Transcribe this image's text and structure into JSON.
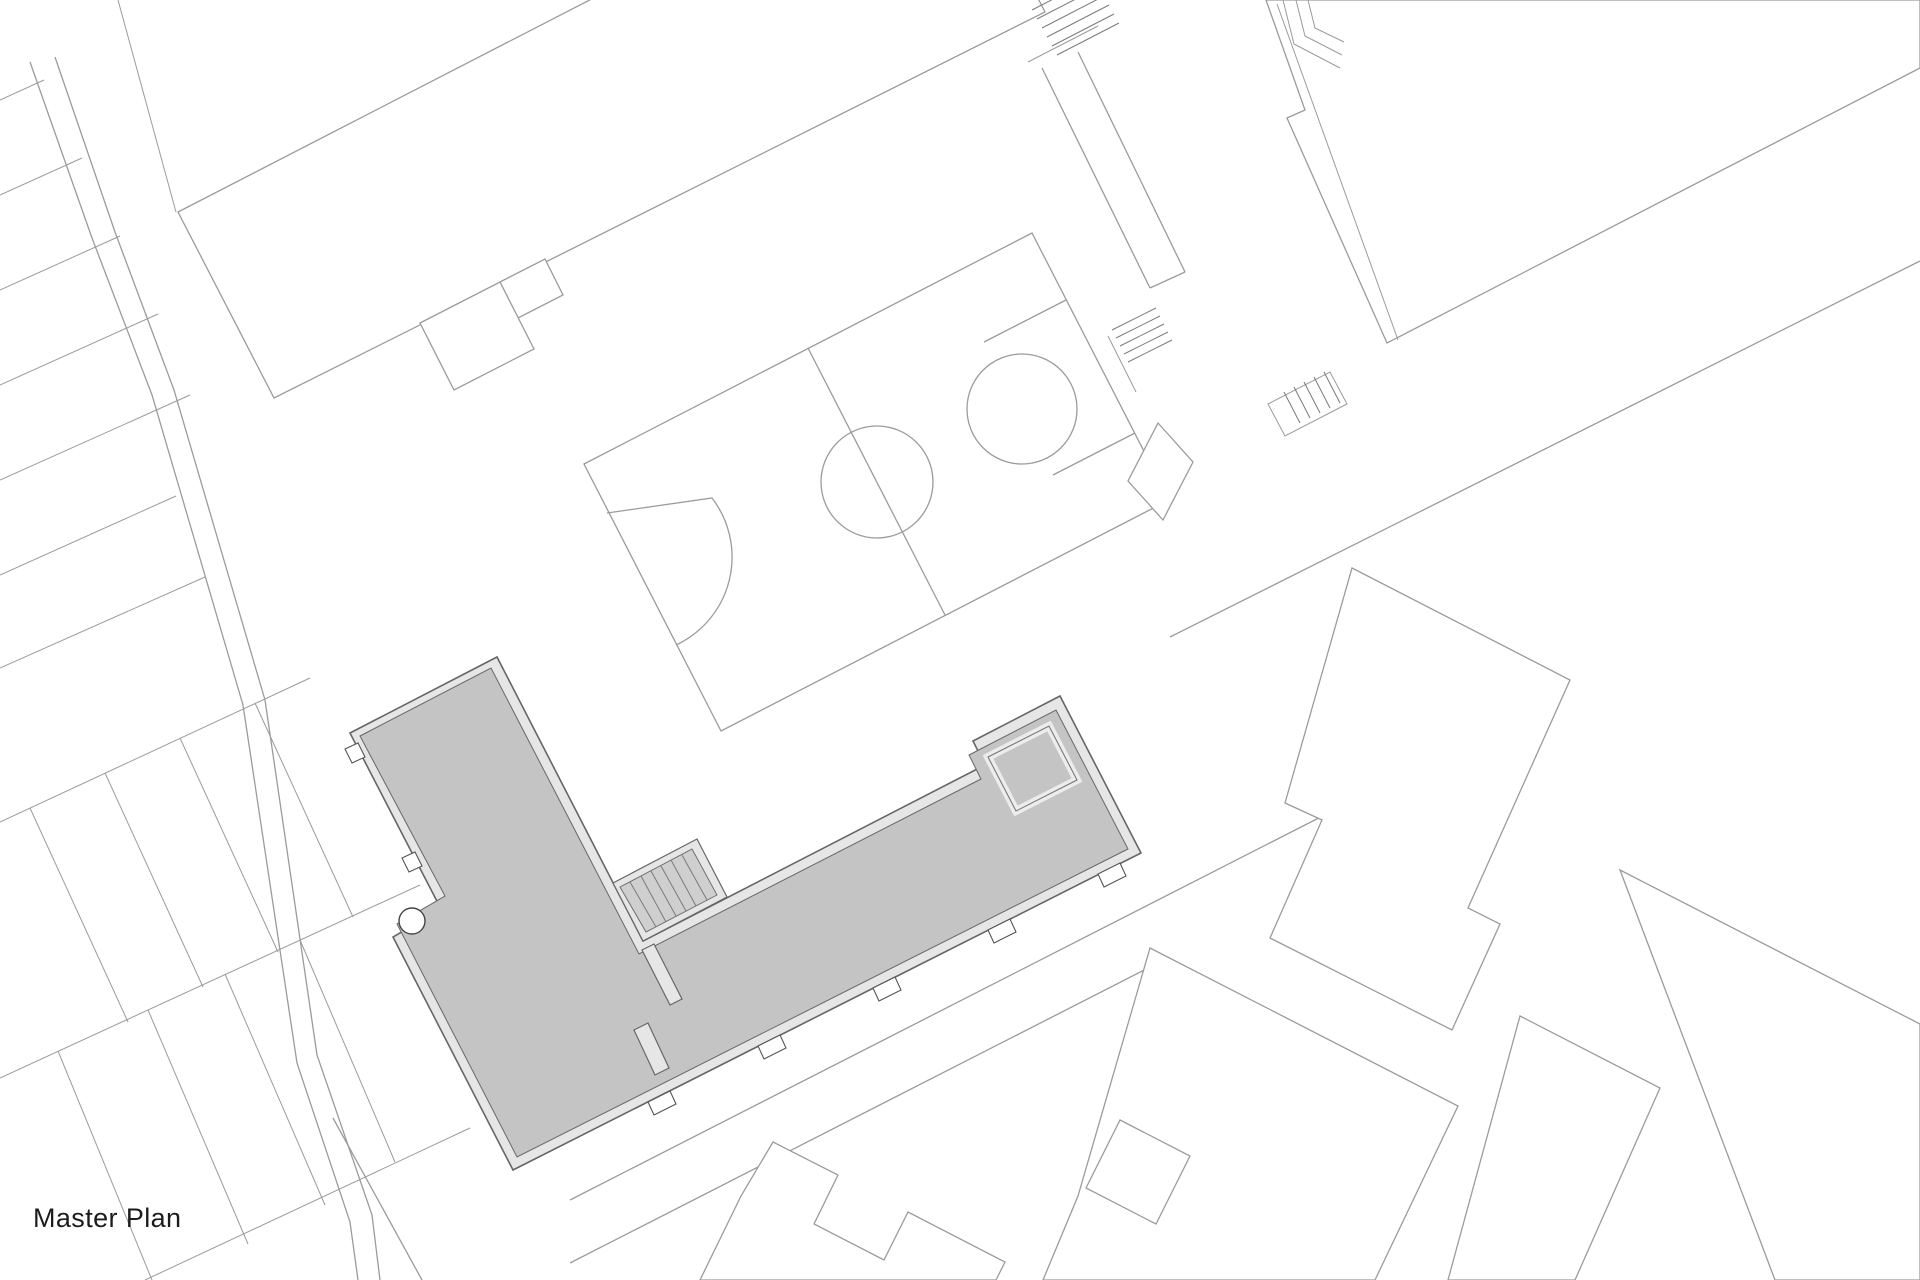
{
  "title": {
    "label": "Master Plan"
  },
  "colors": {
    "bg": "#ffffff",
    "line": "#9b9b9b",
    "text": "#1c1c1c",
    "hl": "#c4c4c4",
    "wall": "#e6e6e6",
    "hl-line": "#666666"
  },
  "site": {
    "type": "architectural site plan",
    "highlighted_building": "L-shaped building with thick walls, interior stair, wall stubs and facade entry ticks",
    "features": [
      "basketball-court with center circle, center line, three-point arc and free-throw circle",
      "large white building top-left with stepped lower notch",
      "narrow walkway strip with two exterior stairs top-right",
      "large white building top-right with nested corner ramp lines and exterior stair",
      "square pad east of court",
      "two parallel street lines south of highlighted building",
      "white buildings with notched outlines bottom-center and bottom-right",
      "garden plot strips along left edge (top and bottom)",
      "curving double-line road on the left",
      "small circle element at west notch of highlighted building"
    ]
  }
}
